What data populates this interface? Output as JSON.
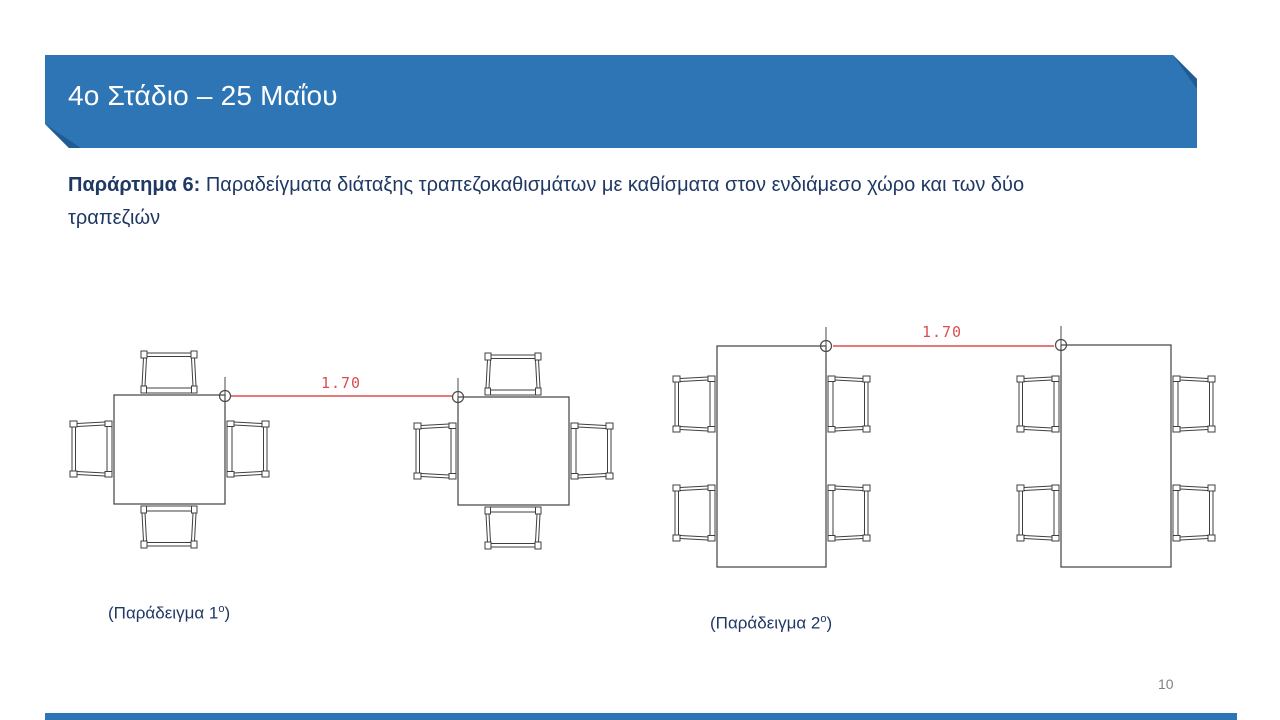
{
  "slide": {
    "header": {
      "title": "4ο Στάδιο – 25 Μαΐου"
    },
    "subtitle": {
      "label_bold": "Παράρτημα 6:",
      "line1": "Παραδείγματα διάταξης τραπεζοκαθισμάτων με καθίσματα στον ενδιάμεσο χώρο και των δύο",
      "line2": "τραπεζιών"
    },
    "figures": [
      {
        "dimension": "1.70",
        "caption_pre": "(Παράδειγμα 1",
        "caption_sup": "ο",
        "caption_post": ")"
      },
      {
        "dimension": "1.70",
        "caption_pre": "(Παράδειγμα 2",
        "caption_sup": "ο",
        "caption_post": ")"
      }
    ],
    "page_number": "10",
    "colors": {
      "banner_blue": "#2E75B6",
      "banner_fold": "#1E5C93",
      "banner_text": "#FFFFFF",
      "body_navy": "#1F3864",
      "dimension_red": "#DC4F4F",
      "drawing_stroke": "#3F3F3F",
      "page_number_gray": "#808080",
      "footer_bar": "#2E75B6"
    }
  }
}
